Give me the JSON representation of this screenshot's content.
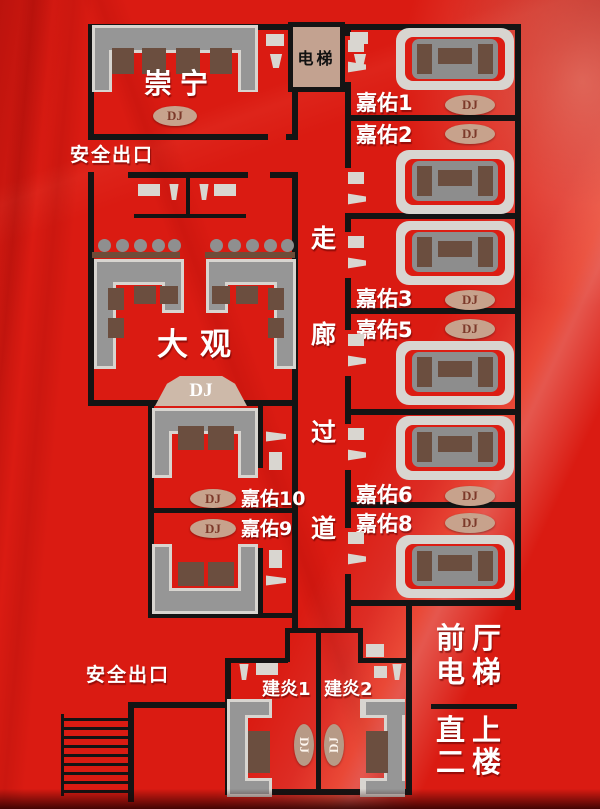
{
  "title": "KTV floor plan",
  "colors": {
    "background_red": "#da1b12",
    "wall_black": "#141414",
    "sofa_gray": "#969696",
    "sofa_frame": "#d8d5d0",
    "cushion_brown": "#6b4e3f",
    "dj_pill_tan": "#c7a28c",
    "stage_tan": "#cdb9a9",
    "elevator_tan": "#c3a290",
    "text_white": "#ffffff"
  },
  "rooms": {
    "chongning": {
      "label": "崇宁",
      "dj": "DJ"
    },
    "elevator": {
      "label": "电梯"
    },
    "daguan": {
      "label": "大观",
      "dj": "DJ"
    },
    "jiayou1": {
      "label": "嘉佑1",
      "dj": "DJ"
    },
    "jiayou2": {
      "label": "嘉佑2",
      "dj": "DJ"
    },
    "jiayou3": {
      "label": "嘉佑3",
      "dj": "DJ"
    },
    "jiayou5": {
      "label": "嘉佑5",
      "dj": "DJ"
    },
    "jiayou6": {
      "label": "嘉佑6",
      "dj": "DJ"
    },
    "jiayou8": {
      "label": "嘉佑8",
      "dj": "DJ"
    },
    "jiayou10": {
      "label": "嘉佑10",
      "dj": "DJ"
    },
    "jiayou9": {
      "label": "嘉佑9",
      "dj": "DJ"
    },
    "jianyan1": {
      "label": "建炎1",
      "dj": "DJ"
    },
    "jianyan2": {
      "label": "建炎2",
      "dj": "DJ"
    }
  },
  "corridor": {
    "char1": "走",
    "char2": "廊",
    "char3": "过",
    "char4": "道"
  },
  "exits": {
    "top": "安全出口",
    "bottom": "安全出口"
  },
  "lobby": {
    "line1": "前厅",
    "line2": "电梯",
    "line3": "直上",
    "line4": "二楼"
  }
}
